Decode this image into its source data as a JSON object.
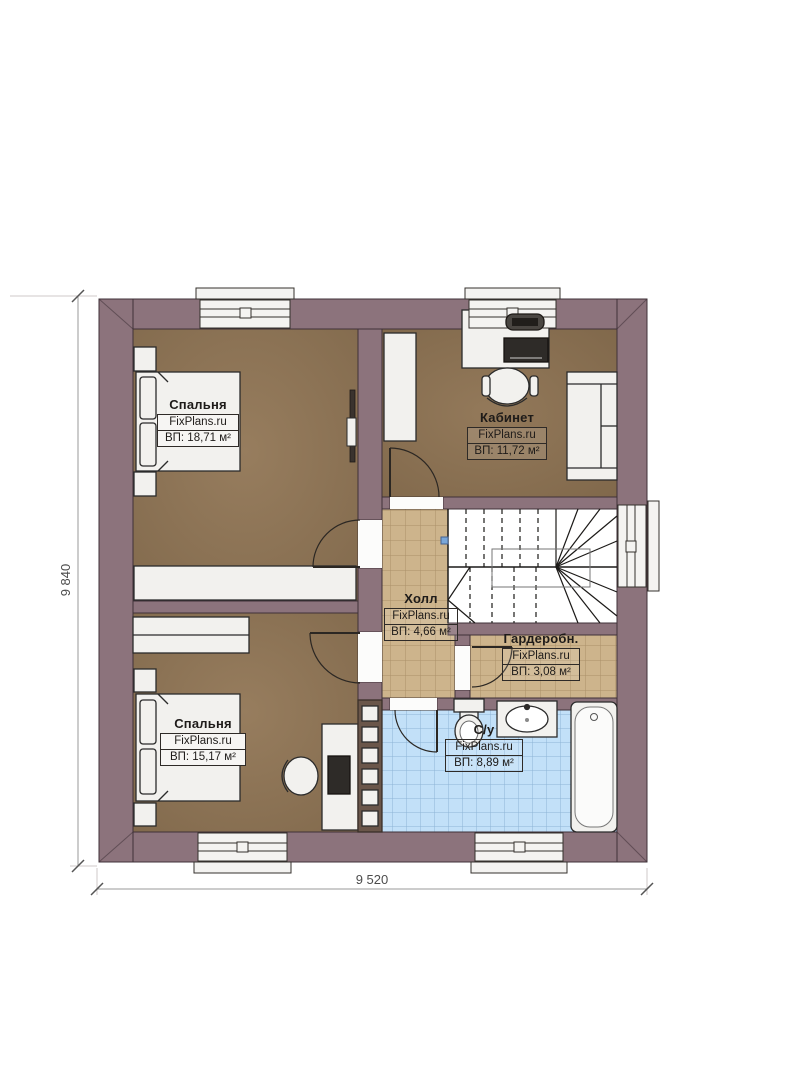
{
  "plan": {
    "rooms": [
      {
        "id": "bedroom-1",
        "name": "Спальня",
        "brand": "FixPlans.ru",
        "area": "ВП: 18,71 м²"
      },
      {
        "id": "office",
        "name": "Кабинет",
        "brand": "FixPlans.ru",
        "area": "ВП: 11,72 м²"
      },
      {
        "id": "hall",
        "name": "Холл",
        "brand": "FixPlans.ru",
        "area": "ВП: 4,66 м²"
      },
      {
        "id": "wardrobe",
        "name": "Гардеробн.",
        "brand": "FixPlans.ru",
        "area": "ВП: 3,08 м²"
      },
      {
        "id": "bedroom-2",
        "name": "Спальня",
        "brand": "FixPlans.ru",
        "area": "ВП: 15,17 м²"
      },
      {
        "id": "bathroom",
        "name": "С/у",
        "brand": "FixPlans.ru",
        "area": "ВП: 8,89 м²"
      }
    ],
    "dimensions": {
      "overall_height_mm": "9 840",
      "overall_width_mm": "9 520"
    },
    "colors": {
      "wall": "#8c737c",
      "wood_floor": "#8e7557",
      "tile_beige": "#cdb48c",
      "tile_blue": "#c2e0f8",
      "fixture_white": "#f2f1ee"
    }
  }
}
